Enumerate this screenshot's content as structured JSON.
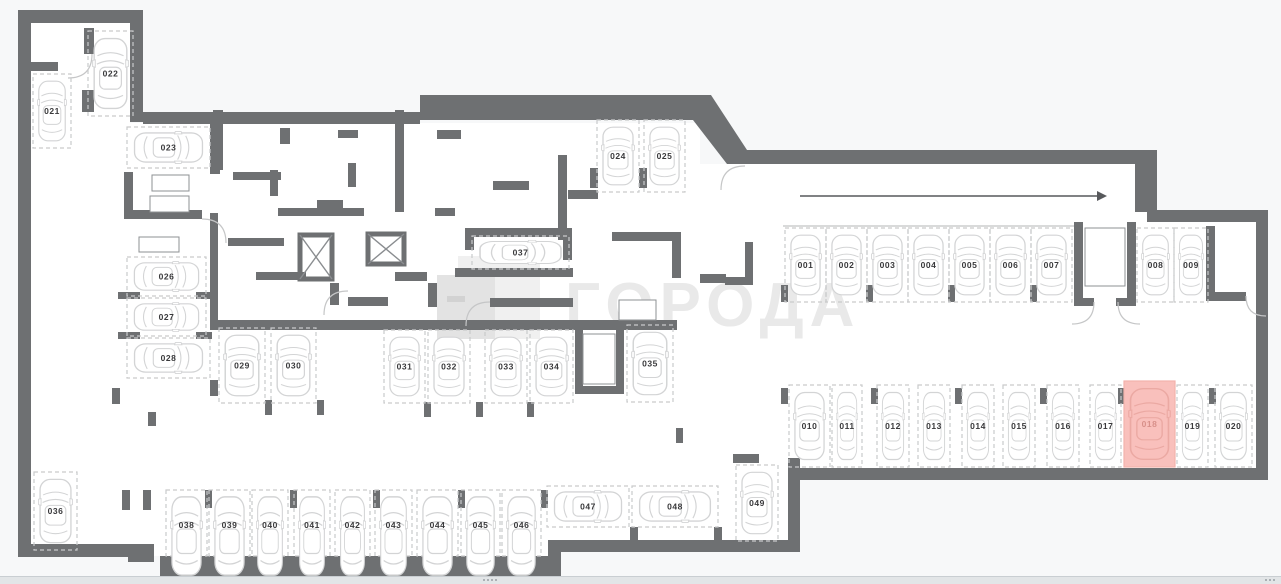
{
  "watermark": {
    "text": "ГОРОДА",
    "logo_icon": "goroda-logo"
  },
  "direction_arrow": {
    "icon": "arrow-right-icon",
    "direction": "right"
  },
  "parking": {
    "selected_stall": "018",
    "stalls": [
      {
        "id": "001"
      },
      {
        "id": "002"
      },
      {
        "id": "003"
      },
      {
        "id": "004"
      },
      {
        "id": "005"
      },
      {
        "id": "006"
      },
      {
        "id": "007"
      },
      {
        "id": "008"
      },
      {
        "id": "009"
      },
      {
        "id": "010"
      },
      {
        "id": "011"
      },
      {
        "id": "012"
      },
      {
        "id": "013"
      },
      {
        "id": "014"
      },
      {
        "id": "015"
      },
      {
        "id": "016"
      },
      {
        "id": "017"
      },
      {
        "id": "018",
        "highlighted": true
      },
      {
        "id": "019"
      },
      {
        "id": "020"
      },
      {
        "id": "021"
      },
      {
        "id": "022"
      },
      {
        "id": "023"
      },
      {
        "id": "024"
      },
      {
        "id": "025"
      },
      {
        "id": "026"
      },
      {
        "id": "027"
      },
      {
        "id": "028"
      },
      {
        "id": "029"
      },
      {
        "id": "030"
      },
      {
        "id": "031"
      },
      {
        "id": "032"
      },
      {
        "id": "033"
      },
      {
        "id": "034"
      },
      {
        "id": "035"
      },
      {
        "id": "036"
      },
      {
        "id": "037"
      },
      {
        "id": "038"
      },
      {
        "id": "039"
      },
      {
        "id": "040"
      },
      {
        "id": "041"
      },
      {
        "id": "042"
      },
      {
        "id": "043"
      },
      {
        "id": "044"
      },
      {
        "id": "045"
      },
      {
        "id": "046"
      },
      {
        "id": "047"
      },
      {
        "id": "048"
      },
      {
        "id": "049"
      }
    ]
  },
  "icons": {
    "car": "car-top-view-icon",
    "stairs": "stairs-icon",
    "elevator": "elevator-shaft-icon",
    "scroll_grip": "drag-grip-icon",
    "resize": "resize-corner-icon"
  },
  "colors": {
    "background": "#f7f8f9",
    "floor": "#ffffff",
    "wall": "#6e7072",
    "stall_dash": "#c9cacb",
    "car_outline": "#d3d4d5",
    "label": "#39393b",
    "highlight_fill": "#f9c0bc",
    "highlight_car": "#eba9a3",
    "highlight_label": "#d8908a",
    "arrow": "#57595c",
    "watermark": "#e9e9e9"
  }
}
